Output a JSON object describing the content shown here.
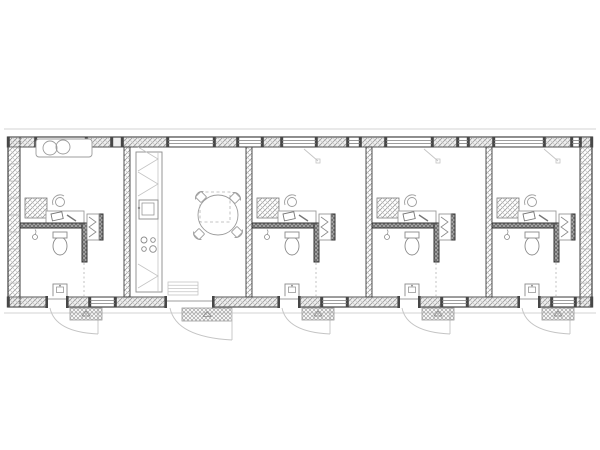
{
  "page": {
    "background": "#ffffff",
    "figure_name": "linear-building-floor-plan"
  },
  "colors": {
    "paper": "#ffffff",
    "wall_line": "#3f3f3f",
    "wall_fill": "#efefef",
    "hatch_line_a": "#8f8f8f",
    "hatch_line_b": "#c6c6c6",
    "dark_hatch_bg": "#a9a9a9",
    "dark_hatch_line": "#5f5f5f",
    "post_fill": "#474747",
    "glass_line": "#7d7d7d",
    "furniture_line": "#9c9c9c",
    "fixture_line": "#8a8a8a",
    "light_line": "#c4c4c4",
    "dash_line": "#b2b2b2",
    "mat_line": "#a5a5a5",
    "tick_line": "#ababab"
  },
  "plan": {
    "canvas": {
      "w": 600,
      "h": 450
    },
    "outer": {
      "x": 8,
      "y": 137,
      "w": 584,
      "h": 170
    },
    "wall_t": 10,
    "overhang": {
      "top_y": 129,
      "bottom_y": 313,
      "x1": 4,
      "x2": 596
    },
    "side_tick_step": 17,
    "top_piers": [
      [
        8,
        36
      ],
      [
        86,
        112
      ],
      [
        122,
        168
      ],
      [
        214,
        238
      ],
      [
        262,
        282
      ],
      [
        316,
        348
      ],
      [
        360,
        386
      ],
      [
        432,
        458
      ],
      [
        468,
        494
      ],
      [
        544,
        572
      ],
      [
        580,
        592
      ]
    ],
    "top_windows": [
      [
        36,
        86
      ],
      [
        168,
        214
      ],
      [
        238,
        262
      ],
      [
        282,
        316
      ],
      [
        348,
        360
      ],
      [
        386,
        432
      ],
      [
        458,
        468
      ],
      [
        494,
        544
      ],
      [
        572,
        580
      ]
    ],
    "bottom_piers": [
      [
        8,
        48
      ],
      [
        66,
        90
      ],
      [
        115,
        167
      ],
      [
        212,
        280
      ],
      [
        298,
        322
      ],
      [
        347,
        400
      ],
      [
        418,
        442
      ],
      [
        467,
        520
      ],
      [
        538,
        552
      ],
      [
        575,
        592
      ]
    ],
    "bottom_windows": [
      [
        90,
        115
      ],
      [
        322,
        347
      ],
      [
        442,
        467
      ],
      [
        552,
        575
      ]
    ],
    "partitions_x": [
      124,
      246,
      366,
      486
    ],
    "partition_w": 6,
    "units": [
      {
        "name": "unit-1",
        "x": 20,
        "w": 104,
        "window_seat": true
      },
      {
        "name": "unit-2",
        "x": 252,
        "w": 114,
        "window_seat": false
      },
      {
        "name": "unit-3",
        "x": 372,
        "w": 114,
        "window_seat": false
      },
      {
        "name": "unit-4",
        "x": 492,
        "w": 88,
        "window_seat": false
      }
    ],
    "unit_template": {
      "shelf": [
        5,
        198,
        22,
        20
      ],
      "desk": [
        26,
        211,
        38,
        12
      ],
      "laptop": [
        31,
        214,
        11,
        7
      ],
      "pen": [
        47,
        215,
        56,
        221
      ],
      "desk_chair": {
        "cx": 40,
        "cy": 202,
        "r": 4.5
      },
      "partition": [
        0,
        223,
        64,
        5
      ],
      "plumb_wall": [
        62,
        223,
        5,
        39
      ],
      "shower": [
        67,
        214,
        12,
        26
      ],
      "shower_wall": [
        79,
        214,
        4,
        26
      ],
      "toilet": {
        "cx": 40,
        "cy": 246,
        "rx": 7,
        "ry": 9,
        "tank": [
          33,
          232,
          14,
          6
        ]
      },
      "pendant": {
        "cx": 15,
        "cy": 237,
        "r": 2.5
      },
      "sink": [
        33,
        284,
        14,
        13
      ],
      "bath_dash": {
        "x": 64,
        "y1": 263,
        "y2": 296
      },
      "door": {
        "x1": 28,
        "x2": 46
      },
      "mat": [
        50,
        308,
        32,
        12
      ],
      "window_mark": [
        52,
        149,
        66,
        161
      ]
    },
    "window_seat": {
      "rect": [
        36,
        139,
        56,
        18
      ],
      "circles": [
        [
          50,
          148,
          7
        ],
        [
          63,
          147,
          7
        ]
      ]
    },
    "common": {
      "name": "kitchen-dining",
      "x": 130,
      "w": 116,
      "counter": {
        "rect": [
          136,
          152,
          26,
          140
        ],
        "front_x": 158
      },
      "kitchen_sink": {
        "rect": [
          139,
          200,
          19,
          19
        ],
        "basin": [
          142,
          203,
          12,
          12
        ],
        "faucet": [
          139,
          208
        ]
      },
      "cooktop": {
        "circles": [
          [
            144,
            240,
            3
          ],
          [
            153,
            240,
            2.3
          ],
          [
            144,
            249,
            2.3
          ],
          [
            153,
            249,
            3.3
          ]
        ]
      },
      "chevrons": [
        [
          138,
          171,
          158,
          159,
          138,
          147
        ],
        [
          138,
          196,
          158,
          184,
          138,
          172
        ],
        [
          138,
          288,
          158,
          276,
          138,
          264
        ]
      ],
      "table": {
        "cx": 218,
        "cy": 215,
        "r": 20,
        "dash_rect": [
          200,
          192,
          30,
          30
        ]
      },
      "chairs": [
        {
          "cx": 201,
          "cy": 197,
          "rot": -45
        },
        {
          "cx": 235,
          "cy": 198,
          "rot": 45
        },
        {
          "cx": 237,
          "cy": 232,
          "rot": 135
        },
        {
          "cx": 199,
          "cy": 234,
          "rot": 225
        }
      ],
      "entry": {
        "x1": 167,
        "x2": 212,
        "steps": [
          168,
          282,
          30,
          13
        ],
        "mat": [
          182,
          308,
          50,
          13
        ]
      }
    }
  }
}
